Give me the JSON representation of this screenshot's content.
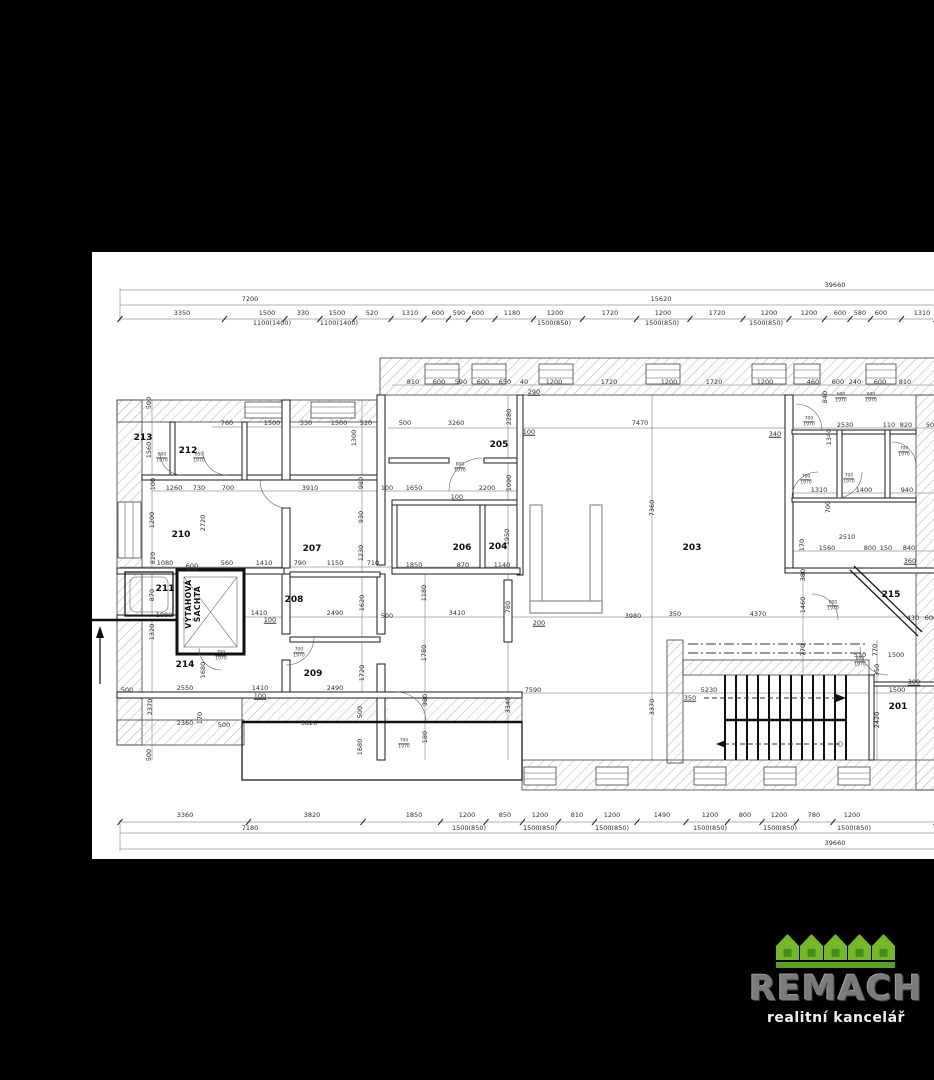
{
  "colors": {
    "canvas": "#000000",
    "paper": "#ffffff",
    "ink": "#1a1a1a",
    "hatch": "#b5b5b5",
    "logo_green": "#76b82a",
    "logo_green_dark": "#458c1e",
    "logo_band": "#5aa022",
    "logo_gray": "#7b7b7b",
    "logo_white": "#f0f0f0"
  },
  "logo": {
    "brand": "REMACH",
    "subtitle": "realitní kancelář"
  },
  "plan": {
    "shaft": {
      "line1": "VÝTAHOVÁ",
      "line2": "ŠACHTA"
    },
    "rooms": [
      {
        "id": "201",
        "x": 806,
        "y": 455
      },
      {
        "id": "203",
        "x": 600,
        "y": 296
      },
      {
        "id": "204",
        "x": 406,
        "y": 295
      },
      {
        "id": "205",
        "x": 407,
        "y": 193
      },
      {
        "id": "206",
        "x": 370,
        "y": 296
      },
      {
        "id": "207",
        "x": 220,
        "y": 297
      },
      {
        "id": "208",
        "x": 202,
        "y": 348
      },
      {
        "id": "209",
        "x": 221,
        "y": 422
      },
      {
        "id": "210",
        "x": 89,
        "y": 283
      },
      {
        "id": "211",
        "x": 73,
        "y": 337
      },
      {
        "id": "212",
        "x": 96,
        "y": 199
      },
      {
        "id": "213",
        "x": 51,
        "y": 186
      },
      {
        "id": "214",
        "x": 93,
        "y": 413
      },
      {
        "id": "215",
        "x": 799,
        "y": 343
      }
    ],
    "dims_h": [
      {
        "t": "39660",
        "x": 743,
        "y": 33
      },
      {
        "t": "7200",
        "x": 158,
        "y": 47
      },
      {
        "t": "15620",
        "x": 569,
        "y": 47
      },
      {
        "t": "3350",
        "x": 90,
        "y": 61
      },
      {
        "t": "1500",
        "x": 175,
        "y": 61
      },
      {
        "t": "330",
        "x": 211,
        "y": 61
      },
      {
        "t": "1500",
        "x": 245,
        "y": 61
      },
      {
        "t": "520",
        "x": 280,
        "y": 61
      },
      {
        "t": "1310",
        "x": 318,
        "y": 61
      },
      {
        "t": "600",
        "x": 346,
        "y": 61
      },
      {
        "t": "590",
        "x": 367,
        "y": 61
      },
      {
        "t": "600",
        "x": 386,
        "y": 61
      },
      {
        "t": "1180",
        "x": 420,
        "y": 61
      },
      {
        "t": "1200",
        "x": 463,
        "y": 61
      },
      {
        "t": "1720",
        "x": 518,
        "y": 61
      },
      {
        "t": "1200",
        "x": 571,
        "y": 61
      },
      {
        "t": "1720",
        "x": 625,
        "y": 61
      },
      {
        "t": "1200",
        "x": 677,
        "y": 61
      },
      {
        "t": "1200",
        "x": 717,
        "y": 61
      },
      {
        "t": "600",
        "x": 748,
        "y": 61
      },
      {
        "t": "580",
        "x": 768,
        "y": 61
      },
      {
        "t": "600",
        "x": 789,
        "y": 61
      },
      {
        "t": "1310",
        "x": 830,
        "y": 61
      },
      {
        "t": "1100(1400)",
        "x": 180,
        "y": 71
      },
      {
        "t": "1100(1400)",
        "x": 247,
        "y": 71
      },
      {
        "t": "1500(850)",
        "x": 462,
        "y": 71
      },
      {
        "t": "1500(850)",
        "x": 570,
        "y": 71
      },
      {
        "t": "1500(850)",
        "x": 674,
        "y": 71
      },
      {
        "t": "810",
        "x": 321,
        "y": 130
      },
      {
        "t": "600",
        "x": 347,
        "y": 130
      },
      {
        "t": "590",
        "x": 369,
        "y": 130
      },
      {
        "t": "600",
        "x": 391,
        "y": 130
      },
      {
        "t": "650",
        "x": 413,
        "y": 130
      },
      {
        "t": "40",
        "x": 432,
        "y": 130
      },
      {
        "t": "1200",
        "x": 462,
        "y": 130
      },
      {
        "t": "1720",
        "x": 517,
        "y": 130
      },
      {
        "t": "1200",
        "x": 577,
        "y": 130
      },
      {
        "t": "1720",
        "x": 622,
        "y": 130
      },
      {
        "t": "1200",
        "x": 673,
        "y": 130
      },
      {
        "t": "460",
        "x": 721,
        "y": 130
      },
      {
        "t": "600",
        "x": 746,
        "y": 130
      },
      {
        "t": "240",
        "x": 763,
        "y": 130
      },
      {
        "t": "600",
        "x": 788,
        "y": 130
      },
      {
        "t": "810",
        "x": 813,
        "y": 130
      },
      {
        "t": "290",
        "x": 442,
        "y": 140,
        "u": 1
      },
      {
        "t": "760",
        "x": 135,
        "y": 171
      },
      {
        "t": "1500",
        "x": 180,
        "y": 171
      },
      {
        "t": "330",
        "x": 214,
        "y": 171
      },
      {
        "t": "1500",
        "x": 247,
        "y": 171
      },
      {
        "t": "520",
        "x": 274,
        "y": 171
      },
      {
        "t": "500",
        "x": 313,
        "y": 171
      },
      {
        "t": "3260",
        "x": 364,
        "y": 171
      },
      {
        "t": "7470",
        "x": 548,
        "y": 171
      },
      {
        "t": "2530",
        "x": 753,
        "y": 173
      },
      {
        "t": "110",
        "x": 797,
        "y": 173
      },
      {
        "t": "820",
        "x": 814,
        "y": 173
      },
      {
        "t": "50",
        "x": 838,
        "y": 173
      },
      {
        "t": "100",
        "x": 437,
        "y": 180,
        "u": 1
      },
      {
        "t": "340",
        "x": 683,
        "y": 182,
        "u": 1
      },
      {
        "t": "1260",
        "x": 82,
        "y": 236
      },
      {
        "t": "730",
        "x": 107,
        "y": 236
      },
      {
        "t": "700",
        "x": 136,
        "y": 236
      },
      {
        "t": "3910",
        "x": 218,
        "y": 236
      },
      {
        "t": "100",
        "x": 295,
        "y": 236
      },
      {
        "t": "1650",
        "x": 322,
        "y": 236
      },
      {
        "t": "2200",
        "x": 395,
        "y": 236
      },
      {
        "t": "1310",
        "x": 727,
        "y": 238
      },
      {
        "t": "1400",
        "x": 772,
        "y": 238
      },
      {
        "t": "940",
        "x": 815,
        "y": 238
      },
      {
        "t": "100",
        "x": 365,
        "y": 245,
        "u": 1
      },
      {
        "t": "2510",
        "x": 755,
        "y": 285
      },
      {
        "t": "1560",
        "x": 735,
        "y": 296
      },
      {
        "t": "800",
        "x": 778,
        "y": 296
      },
      {
        "t": "150",
        "x": 794,
        "y": 296
      },
      {
        "t": "840",
        "x": 817,
        "y": 296
      },
      {
        "t": "360",
        "x": 818,
        "y": 309,
        "u": 1
      },
      {
        "t": "1080",
        "x": 73,
        "y": 311
      },
      {
        "t": "560",
        "x": 135,
        "y": 311
      },
      {
        "t": "1410",
        "x": 172,
        "y": 311
      },
      {
        "t": "790",
        "x": 208,
        "y": 311
      },
      {
        "t": "1150",
        "x": 243,
        "y": 311
      },
      {
        "t": "710",
        "x": 281,
        "y": 311
      },
      {
        "t": "1850",
        "x": 322,
        "y": 313
      },
      {
        "t": "870",
        "x": 371,
        "y": 313
      },
      {
        "t": "1140",
        "x": 410,
        "y": 313
      },
      {
        "t": "600",
        "x": 100,
        "y": 314,
        "u": 1
      },
      {
        "t": "1410",
        "x": 167,
        "y": 361
      },
      {
        "t": "2490",
        "x": 243,
        "y": 361
      },
      {
        "t": "3410",
        "x": 365,
        "y": 361
      },
      {
        "t": "350",
        "x": 583,
        "y": 362
      },
      {
        "t": "4370",
        "x": 666,
        "y": 362
      },
      {
        "t": "1080",
        "x": 72,
        "y": 363
      },
      {
        "t": "500",
        "x": 295,
        "y": 364
      },
      {
        "t": "3980",
        "x": 541,
        "y": 364
      },
      {
        "t": "430",
        "x": 821,
        "y": 366
      },
      {
        "t": "600",
        "x": 839,
        "y": 366
      },
      {
        "t": "100",
        "x": 178,
        "y": 368,
        "u": 1
      },
      {
        "t": "200",
        "x": 447,
        "y": 371,
        "u": 1
      },
      {
        "t": "510",
        "x": 768,
        "y": 403
      },
      {
        "t": "1500",
        "x": 804,
        "y": 403
      },
      {
        "t": "300",
        "x": 822,
        "y": 430,
        "u": 1
      },
      {
        "t": "2550",
        "x": 93,
        "y": 436
      },
      {
        "t": "1410",
        "x": 168,
        "y": 436
      },
      {
        "t": "2490",
        "x": 243,
        "y": 436
      },
      {
        "t": "500",
        "x": 35,
        "y": 438
      },
      {
        "t": "7590",
        "x": 441,
        "y": 438
      },
      {
        "t": "5230",
        "x": 617,
        "y": 438
      },
      {
        "t": "1500",
        "x": 805,
        "y": 438
      },
      {
        "t": "100",
        "x": 168,
        "y": 444,
        "u": 1
      },
      {
        "t": "350",
        "x": 598,
        "y": 446,
        "u": 1
      },
      {
        "t": "2360",
        "x": 93,
        "y": 471
      },
      {
        "t": "3820",
        "x": 217,
        "y": 471
      },
      {
        "t": "500",
        "x": 132,
        "y": 473
      },
      {
        "t": "3360",
        "x": 93,
        "y": 563
      },
      {
        "t": "3820",
        "x": 220,
        "y": 563
      },
      {
        "t": "1850",
        "x": 322,
        "y": 563
      },
      {
        "t": "1200",
        "x": 375,
        "y": 563
      },
      {
        "t": "850",
        "x": 413,
        "y": 563
      },
      {
        "t": "1200",
        "x": 448,
        "y": 563
      },
      {
        "t": "810",
        "x": 485,
        "y": 563
      },
      {
        "t": "1200",
        "x": 520,
        "y": 563
      },
      {
        "t": "1490",
        "x": 570,
        "y": 563
      },
      {
        "t": "1200",
        "x": 618,
        "y": 563
      },
      {
        "t": "800",
        "x": 653,
        "y": 563
      },
      {
        "t": "1200",
        "x": 687,
        "y": 563
      },
      {
        "t": "780",
        "x": 722,
        "y": 563
      },
      {
        "t": "1200",
        "x": 760,
        "y": 563
      },
      {
        "t": "7180",
        "x": 158,
        "y": 576
      },
      {
        "t": "1500(850)",
        "x": 377,
        "y": 576
      },
      {
        "t": "1500(850)",
        "x": 448,
        "y": 576
      },
      {
        "t": "1500(850)",
        "x": 520,
        "y": 576
      },
      {
        "t": "1500(850)",
        "x": 618,
        "y": 576
      },
      {
        "t": "1500(850)",
        "x": 688,
        "y": 576
      },
      {
        "t": "1500(850)",
        "x": 762,
        "y": 576
      },
      {
        "t": "39660",
        "x": 743,
        "y": 591
      }
    ],
    "dims_v": [
      {
        "t": "500",
        "x": 57,
        "y": 151
      },
      {
        "t": "1560",
        "x": 57,
        "y": 198
      },
      {
        "t": "100",
        "x": 61,
        "y": 232
      },
      {
        "t": "1200",
        "x": 60,
        "y": 268
      },
      {
        "t": "820",
        "x": 61,
        "y": 306
      },
      {
        "t": "870",
        "x": 60,
        "y": 343
      },
      {
        "t": "1320",
        "x": 60,
        "y": 380
      },
      {
        "t": "2370",
        "x": 58,
        "y": 455
      },
      {
        "t": "170",
        "x": 108,
        "y": 466
      },
      {
        "t": "500",
        "x": 57,
        "y": 503
      },
      {
        "t": "1300",
        "x": 262,
        "y": 186
      },
      {
        "t": "980",
        "x": 269,
        "y": 231
      },
      {
        "t": "930",
        "x": 269,
        "y": 265
      },
      {
        "t": "1230",
        "x": 269,
        "y": 301
      },
      {
        "t": "1620",
        "x": 270,
        "y": 351
      },
      {
        "t": "1720",
        "x": 270,
        "y": 421
      },
      {
        "t": "500",
        "x": 268,
        "y": 460
      },
      {
        "t": "1680",
        "x": 268,
        "y": 495
      },
      {
        "t": "2720",
        "x": 111,
        "y": 271
      },
      {
        "t": "1680",
        "x": 111,
        "y": 418
      },
      {
        "t": "2280",
        "x": 417,
        "y": 165
      },
      {
        "t": "1090",
        "x": 417,
        "y": 231
      },
      {
        "t": "1950",
        "x": 415,
        "y": 285
      },
      {
        "t": "780",
        "x": 416,
        "y": 355
      },
      {
        "t": "3340",
        "x": 416,
        "y": 453
      },
      {
        "t": "1180",
        "x": 332,
        "y": 341
      },
      {
        "t": "1780",
        "x": 332,
        "y": 401
      },
      {
        "t": "980",
        "x": 333,
        "y": 448
      },
      {
        "t": "180",
        "x": 333,
        "y": 485
      },
      {
        "t": "7360",
        "x": 560,
        "y": 256
      },
      {
        "t": "3370",
        "x": 560,
        "y": 455
      },
      {
        "t": "840",
        "x": 733,
        "y": 145
      },
      {
        "t": "1340",
        "x": 737,
        "y": 185
      },
      {
        "t": "700",
        "x": 736,
        "y": 255
      },
      {
        "t": "170",
        "x": 710,
        "y": 293
      },
      {
        "t": "380",
        "x": 711,
        "y": 323
      },
      {
        "t": "1460",
        "x": 711,
        "y": 353
      },
      {
        "t": "770",
        "x": 711,
        "y": 398
      },
      {
        "t": "770",
        "x": 783,
        "y": 398
      },
      {
        "t": "350",
        "x": 785,
        "y": 418
      },
      {
        "t": "2420",
        "x": 785,
        "y": 468
      }
    ],
    "door_tags": [
      {
        "top": "600",
        "bottom": "1970",
        "x": 70,
        "y": 206
      },
      {
        "top": "650",
        "bottom": "1970",
        "x": 107,
        "y": 206
      },
      {
        "top": "700",
        "bottom": "1970",
        "x": 129,
        "y": 404
      },
      {
        "top": "700",
        "bottom": "1970",
        "x": 207,
        "y": 401
      },
      {
        "top": "700",
        "bottom": "1970",
        "x": 312,
        "y": 492
      },
      {
        "top": "800",
        "bottom": "1970",
        "x": 368,
        "y": 216
      },
      {
        "top": "700",
        "bottom": "1970",
        "x": 717,
        "y": 170
      },
      {
        "top": "700",
        "bottom": "1970",
        "x": 714,
        "y": 228
      },
      {
        "top": "700",
        "bottom": "1970",
        "x": 757,
        "y": 227
      },
      {
        "top": "600",
        "bottom": "1970",
        "x": 749,
        "y": 146
      },
      {
        "top": "600",
        "bottom": "1970",
        "x": 779,
        "y": 146
      },
      {
        "top": "700",
        "bottom": "1970",
        "x": 812,
        "y": 200
      },
      {
        "top": "800",
        "bottom": "1970",
        "x": 741,
        "y": 354
      },
      {
        "top": "800",
        "bottom": "1970",
        "x": 768,
        "y": 410
      }
    ]
  }
}
